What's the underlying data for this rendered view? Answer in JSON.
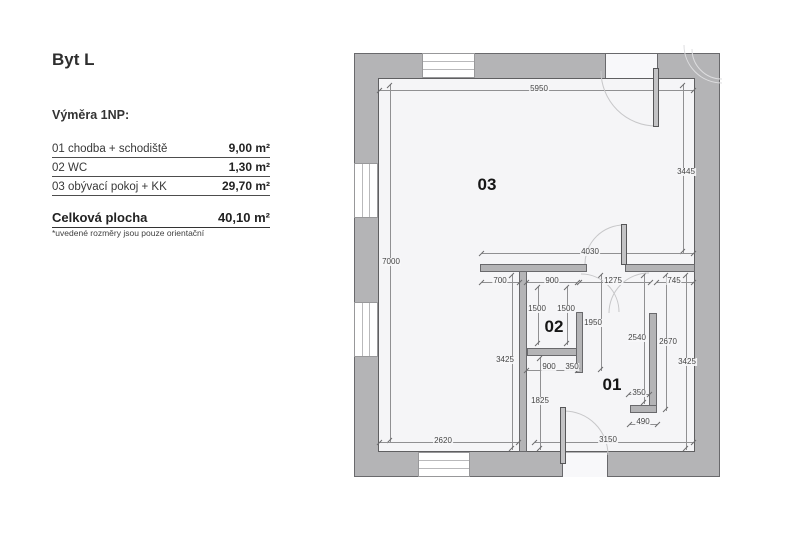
{
  "legend": {
    "title": "Byt L",
    "section_label": "Výměra 1NP:",
    "rows": [
      {
        "label": "01 chodba + schodiště",
        "value": "9,00 m²"
      },
      {
        "label": "02 WC",
        "value": "1,30 m²"
      },
      {
        "label": "03 obývací pokoj + KK",
        "value": "29,70 m²"
      }
    ],
    "total": {
      "label": "Celková plocha",
      "value": "40,10 m²"
    },
    "footnote": "*uvedené rozměry jsou pouze orientační"
  },
  "floorplan": {
    "room_labels": [
      {
        "id": "03"
      },
      {
        "id": "02"
      },
      {
        "id": "01"
      }
    ],
    "dimensions": [
      {
        "t": "5950"
      },
      {
        "t": "3445"
      },
      {
        "t": "7000"
      },
      {
        "t": "4030"
      },
      {
        "t": "700"
      },
      {
        "t": "900"
      },
      {
        "t": "1275"
      },
      {
        "t": "745"
      },
      {
        "t": "1500"
      },
      {
        "t": "1500"
      },
      {
        "t": "1950"
      },
      {
        "t": "2540"
      },
      {
        "t": "2670"
      },
      {
        "t": "3425"
      },
      {
        "t": "3425"
      },
      {
        "t": "900"
      },
      {
        "t": "350"
      },
      {
        "t": "1825"
      },
      {
        "t": "350"
      },
      {
        "t": "490"
      },
      {
        "t": "2620"
      },
      {
        "t": "3150"
      }
    ]
  },
  "colors": {
    "wall_fill": "#b4b4b6",
    "wall_outline": "#69696c",
    "floor_fill": "#f5f5f7",
    "dimension_line": "#909092",
    "dimension_text": "#454545",
    "text": "#383838"
  }
}
